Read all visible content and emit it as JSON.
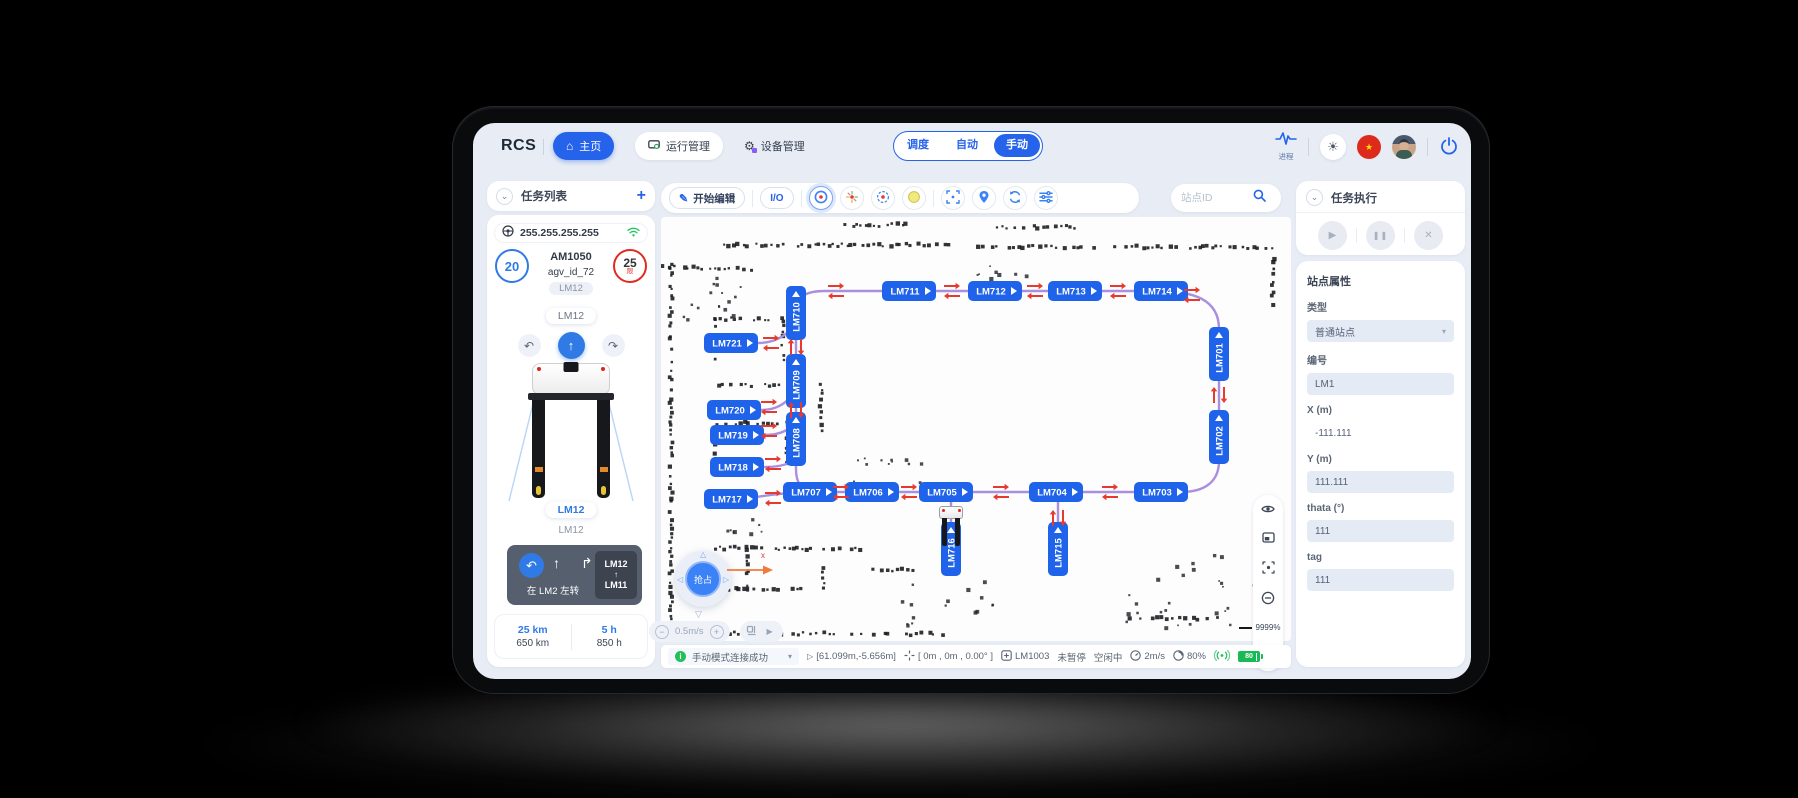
{
  "topbar": {
    "logo": "RCS",
    "nav": [
      {
        "label": "主页"
      },
      {
        "label": "运行管理"
      },
      {
        "label": "设备管理"
      }
    ],
    "modes": [
      "调度",
      "自动",
      "手动"
    ],
    "selected_mode": "手动",
    "process_label": "进程"
  },
  "icons": {
    "home": "⌂",
    "gear": "⚙",
    "sun": "☀",
    "star": "★",
    "plus": "+",
    "minus": "−",
    "chevron_down": "⌄",
    "caret_down": "▾",
    "play": "▶",
    "pause": "❚❚",
    "close": "✕",
    "up_arrow": "↑",
    "turn_left": "↶",
    "turn_right": "↷",
    "fwd_right": "↱",
    "tri_left": "◁",
    "tri_right": "▷",
    "tri_down": "▽",
    "tri_up": "△",
    "cursor": "▷",
    "io": "I/O"
  },
  "left_panel": {
    "task_list_title": "任务列表",
    "ip": "255.255.255.255",
    "battery_circle": "20",
    "limit_circle": "25",
    "limit_sub": "限",
    "vehicle_model": "AM1050",
    "vehicle_id": "agv_id_72",
    "vehicle_tag": "LM12",
    "station_pill_top": "LM12",
    "station_pill_bottom": "LM12",
    "station_text": "LM12",
    "action_text": "在 LM2 左转",
    "route_from": "LM12",
    "route_arrow": "↑",
    "route_to": "LM11",
    "stat_km_current": "25 km",
    "stat_km_total": "650 km",
    "stat_h_current": "5 h",
    "stat_h_total": "850 h"
  },
  "map_toolbar": {
    "edit_button": "开始编辑",
    "io_button": "I/O",
    "search_placeholder": "站点ID"
  },
  "map": {
    "zoom_label": "9999%",
    "joystick_label": "抢占",
    "speed_label": "0.5m/s",
    "axis_label": "x",
    "nodes": [
      {
        "id": "LM710",
        "x": 135,
        "y": 96,
        "o": "v"
      },
      {
        "id": "LM711",
        "x": 248,
        "y": 74,
        "o": "h"
      },
      {
        "id": "LM712",
        "x": 334,
        "y": 74,
        "o": "h"
      },
      {
        "id": "LM713",
        "x": 414,
        "y": 74,
        "o": "h"
      },
      {
        "id": "LM714",
        "x": 500,
        "y": 74,
        "o": "h"
      },
      {
        "id": "LM701",
        "x": 558,
        "y": 137,
        "o": "v"
      },
      {
        "id": "LM702",
        "x": 558,
        "y": 220,
        "o": "v"
      },
      {
        "id": "LM703",
        "x": 500,
        "y": 275,
        "o": "h"
      },
      {
        "id": "LM704",
        "x": 395,
        "y": 275,
        "o": "h"
      },
      {
        "id": "LM705",
        "x": 285,
        "y": 275,
        "o": "h"
      },
      {
        "id": "LM706",
        "x": 211,
        "y": 275,
        "o": "h"
      },
      {
        "id": "LM707",
        "x": 149,
        "y": 275,
        "o": "h"
      },
      {
        "id": "LM709",
        "x": 135,
        "y": 164,
        "o": "v"
      },
      {
        "id": "LM708",
        "x": 135,
        "y": 222,
        "o": "v"
      },
      {
        "id": "LM721",
        "x": 70,
        "y": 126,
        "o": "h"
      },
      {
        "id": "LM720",
        "x": 73,
        "y": 193,
        "o": "h"
      },
      {
        "id": "LM719",
        "x": 76,
        "y": 218,
        "o": "h"
      },
      {
        "id": "LM718",
        "x": 76,
        "y": 250,
        "o": "h"
      },
      {
        "id": "LM717",
        "x": 70,
        "y": 282,
        "o": "h"
      },
      {
        "id": "LM716",
        "x": 290,
        "y": 332,
        "o": "v"
      },
      {
        "id": "LM715",
        "x": 397,
        "y": 332,
        "o": "v"
      }
    ],
    "edges": [
      "M135,92 C135,78 148,74 164,74 L496,74 C532,74 558,82 558,112 L558,244 C558,266 542,275 520,275 L162,275 C132,275 112,277 90,281",
      "M135,92 L135,252 C135,268 142,274 152,275",
      "M97,126 C116,126 130,116 134,104",
      "M100,193 C119,193 131,182 135,170",
      "M103,218 C121,218 131,212 135,202",
      "M104,250 C121,250 131,246 135,240",
      "M290,306 L290,276",
      "M397,306 L397,276"
    ],
    "arrow_pairs": [
      {
        "x": 175,
        "y": 74,
        "d": "h"
      },
      {
        "x": 291,
        "y": 74,
        "d": "h"
      },
      {
        "x": 374,
        "y": 74,
        "d": "h"
      },
      {
        "x": 457,
        "y": 74,
        "d": "h"
      },
      {
        "x": 531,
        "y": 78,
        "d": "h"
      },
      {
        "x": 180,
        "y": 275,
        "d": "h"
      },
      {
        "x": 248,
        "y": 275,
        "d": "h"
      },
      {
        "x": 340,
        "y": 275,
        "d": "h"
      },
      {
        "x": 449,
        "y": 275,
        "d": "h"
      },
      {
        "x": 110,
        "y": 126,
        "d": "h"
      },
      {
        "x": 108,
        "y": 190,
        "d": "h"
      },
      {
        "x": 108,
        "y": 214,
        "d": "h"
      },
      {
        "x": 112,
        "y": 247,
        "d": "h"
      },
      {
        "x": 112,
        "y": 281,
        "d": "h"
      },
      {
        "x": 135,
        "y": 130,
        "d": "v"
      },
      {
        "x": 135,
        "y": 193,
        "d": "v"
      },
      {
        "x": 558,
        "y": 178,
        "d": "v"
      },
      {
        "x": 397,
        "y": 301,
        "d": "v"
      }
    ],
    "walls": [
      [
        55,
        28,
        298,
        28
      ],
      [
        308,
        30,
        610,
        30
      ],
      [
        10,
        46,
        10,
        416
      ],
      [
        0,
        50,
        96,
        52
      ],
      [
        178,
        8,
        250,
        8
      ],
      [
        336,
        10,
        414,
        10
      ],
      [
        160,
        158,
        160,
        214
      ],
      [
        55,
        102,
        122,
        102
      ],
      [
        55,
        104,
        55,
        142
      ],
      [
        122,
        104,
        122,
        142
      ],
      [
        57,
        168,
        122,
        168
      ],
      [
        55,
        206,
        126,
        206
      ],
      [
        55,
        208,
        55,
        246
      ],
      [
        126,
        208,
        126,
        246
      ],
      [
        55,
        331,
        200,
        332
      ],
      [
        86,
        334,
        86,
        372
      ],
      [
        55,
        372,
        140,
        372
      ],
      [
        162,
        346,
        162,
        372
      ],
      [
        212,
        353,
        252,
        353
      ],
      [
        20,
        416,
        282,
        417
      ],
      [
        612,
        32,
        612,
        88
      ],
      [
        470,
        400,
        560,
        402
      ]
    ],
    "speck_boxes": [
      [
        18,
        58,
        70,
        46,
        16
      ],
      [
        190,
        238,
        70,
        30,
        12
      ],
      [
        462,
        336,
        108,
        84,
        20
      ],
      [
        238,
        360,
        104,
        48,
        16
      ],
      [
        310,
        44,
        60,
        18,
        8
      ],
      [
        548,
        336,
        60,
        60,
        10
      ],
      [
        60,
        300,
        40,
        20,
        8
      ]
    ]
  },
  "status_bar": {
    "message": "手动模式连接成功",
    "cursor_pos": "[61.099m,-5.656m]",
    "robot_pose": "[ 0m , 0m , 0.00° ]",
    "station": "LM1003",
    "pause_state": "未暂停",
    "idle_state": "空闲中",
    "speed": "2m/s",
    "load": "80%",
    "battery": "80"
  },
  "right_panel": {
    "task_exec_title": "任务执行",
    "props_title": "站点属性",
    "type_label": "类型",
    "type_value": "普通站点",
    "id_label": "编号",
    "id_value": "LM1",
    "x_label": "X (m)",
    "x_value": "-111.111",
    "y_label": "Y (m)",
    "y_value": "111.111",
    "theta_label": "thata (°)",
    "theta_value": "111",
    "tag_label": "tag",
    "tag_value": "111"
  },
  "colors": {
    "accent": "#2563eb",
    "node_blue": "#1e63e9",
    "path_purple": "#ab8fdf",
    "arrow_red": "#e63a2e",
    "green": "#21c05a",
    "battery_green": "#19b955",
    "limit_red": "#e02b20"
  }
}
